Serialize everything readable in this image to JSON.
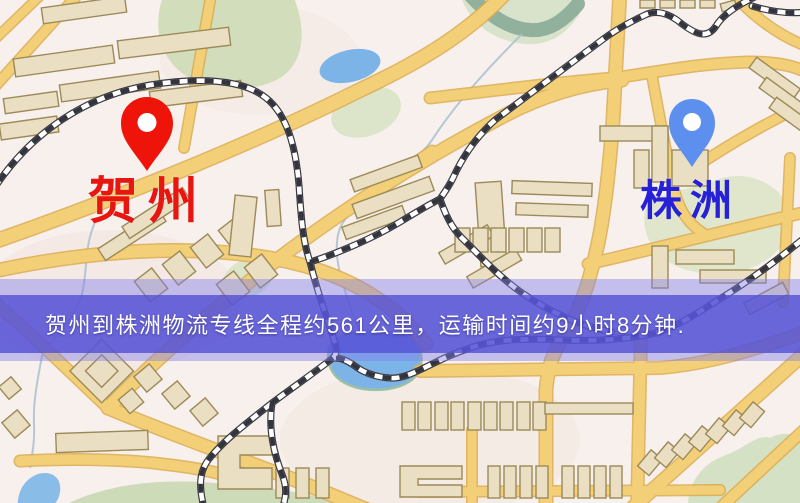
{
  "map": {
    "type": "static-route-map",
    "colors": {
      "background": "#f7f0ec",
      "road": "#f3d077",
      "road_casing": "#dcab4e",
      "building": "#ebdfc3",
      "building_outline": "#9b8a58",
      "park": "#cddcb6",
      "water": "#7db4e8",
      "river": "#8aab97",
      "railway_dark": "#34343e",
      "railway_light": "#ffffff"
    }
  },
  "markers": {
    "origin": {
      "name": "贺州",
      "pin_color": "#ee1409",
      "label_color": "#e81610"
    },
    "destination": {
      "name": "株洲",
      "pin_color": "#5d8fee",
      "label_color": "#2620d6"
    }
  },
  "banner": {
    "text": "贺州到株洲物流专线全程约561公里，运输时间约9小时8分钟.",
    "background": "#5350d4",
    "text_color": "#ffffff",
    "route": {
      "origin": "贺州",
      "destination": "株洲",
      "service": "物流专线",
      "distance": "约561公里",
      "duration": "约9小时8分钟"
    }
  }
}
